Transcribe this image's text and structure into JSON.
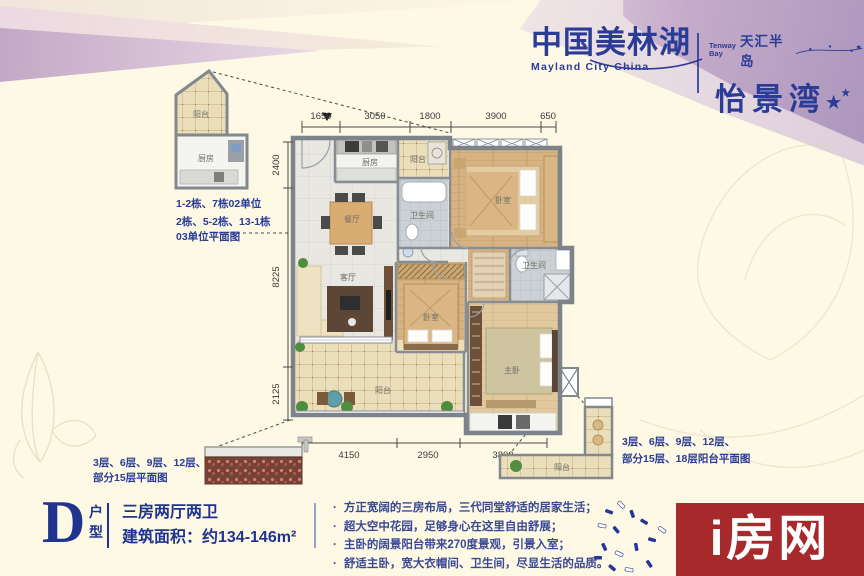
{
  "brand": {
    "name_cn": "中国美林湖",
    "name_en": "Mayland City China",
    "sub_en_1": "Tenway",
    "sub_en_2": "Bay",
    "sub_cn": "天汇半岛",
    "project": "怡景湾",
    "star": "★"
  },
  "plan": {
    "dims_top": [
      "1650",
      "3050",
      "1800",
      "3900",
      "650"
    ],
    "dims_left": [
      "2400",
      "8225",
      "2125"
    ],
    "dims_bottom": [
      "4150",
      "2950",
      "3800"
    ],
    "rooms": {
      "kitchen": "厨房",
      "balcony_small": "阳台",
      "bath1": "卫生间",
      "bedroom1": "卧室",
      "dining": "餐厅",
      "living": "客厅",
      "bedroom2": "卧室",
      "master": "主卧",
      "bath2": "卫生间",
      "balcony_main": "阳台"
    },
    "inset_left": {
      "balcony": "阳台",
      "kitchen": "厨房",
      "line1": "1-2栋、7栋02单位",
      "line2": "2栋、5-2栋、13-1栋",
      "line3": "03单位平面图"
    },
    "inset_bottom_left": {
      "line1": "3层、6层、9层、12层、",
      "line2": "部分15层平面图"
    },
    "inset_bottom_right": {
      "balcony": "阳台",
      "line1": "3层、6层、9层、12层、",
      "line2": "部分15层、18层阳台平面图"
    }
  },
  "unit": {
    "letter": "D",
    "type_top": "户",
    "type_bottom": "型",
    "layout": "三房两厅两卫",
    "area": "建筑面积：约134-146m²"
  },
  "features": {
    "bullet": "·",
    "items": [
      "方正宽阔的三房布局，三代同堂舒适的居家生活；",
      "超大空中花园，足够身心在这里自由舒展；",
      "主卧的阔景阳台带来270度景观，引景入室；",
      "舒适主卧，宽大衣帽间、卫生间，尽显生活的品质。"
    ]
  },
  "watermark": {
    "text": "i房网"
  },
  "colors": {
    "brand_blue": "#2b3c96",
    "watermark_red": "#a8292c",
    "cream": "#fdf9e4",
    "mauve": "#c0a6c6"
  }
}
